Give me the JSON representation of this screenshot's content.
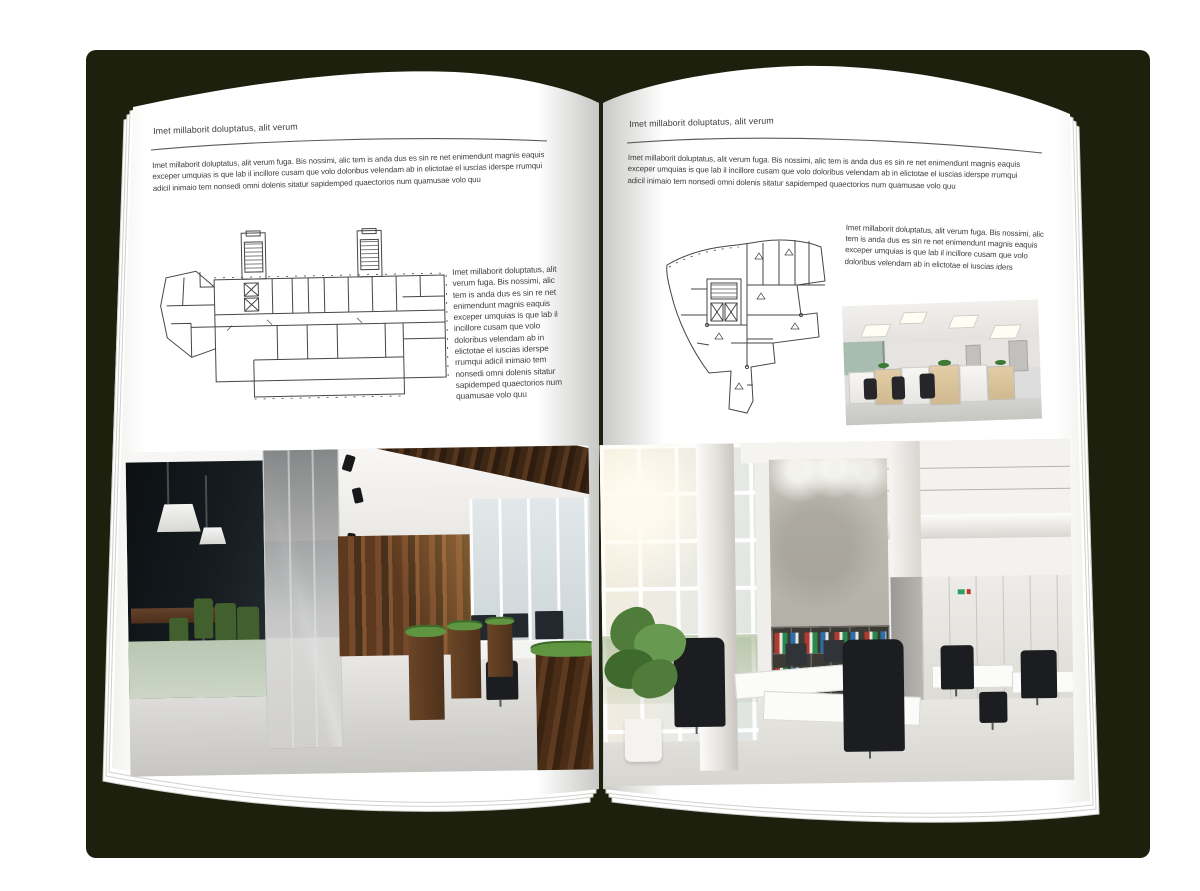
{
  "canvas": {
    "background": "#ffffff",
    "backdrop_color": "#1e200e"
  },
  "left_page": {
    "header": "Imet millaborit doluptatus, alit verum",
    "intro": "Imet millaborit doluptatus, alit verum fuga. Bis nossimi, alic tem is anda dus es sin re net enimendunt magnis eaquis exceper umquias is que lab il incillore cusam que volo doloribus velendam ab in elictotae el iuscias iderspe rrumqui adicil inimaio tem nonsedi omni dolenis sitatur sapidemped quaectorios num quamusae volo quu",
    "caption": "Imet millaborit doluptatus, alit verum fuga. Bis nossimi, alic tem is anda dus es sin re net enimendunt magnis eaquis exceper umquias is que lab il incillore cusam que volo doloribus velendam ab in elictotae el iuscias iderspe rrumqui adicil inimaio tem nonsedi omni dolenis sitatur sapidemped quaectorios num quamusae volo quu"
  },
  "right_page": {
    "header": "Imet millaborit doluptatus, alit verum",
    "intro": "Imet millaborit doluptatus, alit verum fuga. Bis nossimi, alic tem is anda dus es sin re net enimendunt magnis eaquis exceper umquias is que lab il incillore cusam que volo doloribus velendam ab in elictotae el iuscias iderspe rrumqui adicil inimaio tem nonsedi omni dolenis sitatur sapidemped quaectorios num quamusae volo quu",
    "caption": "Imet millaborit doluptatus, alit verum fuga. Bis nossimi, alic tem is anda dus es sin re net enimendunt magnis eaquis exceper umquias is que lab il incillore cusam que volo doloribus velendam ab in elictotae el iuscias iders"
  },
  "palette": {
    "plan_line": "#474644",
    "wood": "#6a4526",
    "grass": "#5f9440",
    "binder_red": "#b03a2e",
    "binder_green": "#27894e",
    "binder_blue": "#2d6fa8"
  }
}
